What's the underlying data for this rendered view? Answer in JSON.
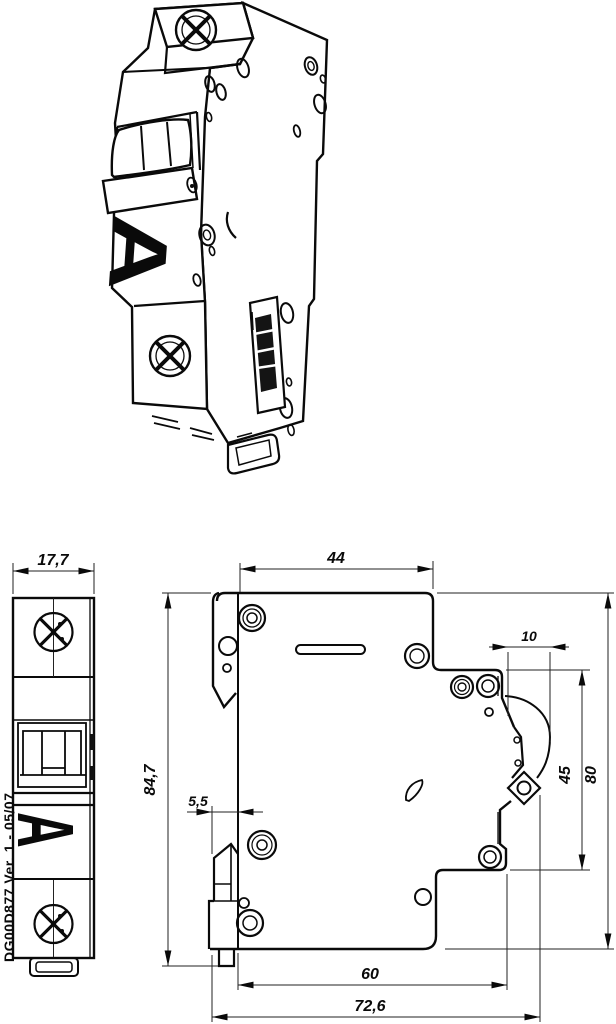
{
  "meta": {
    "drawing_number": "DG00D877 Ver. 1 - 05/07"
  },
  "markings": {
    "letter": "A"
  },
  "dimensions": {
    "front_width": "17,7",
    "top_depth": "44",
    "terminal_recess": "10",
    "terminal_height": "45",
    "body_height": "80",
    "overall_height": "84,7",
    "rail_clip": "5,5",
    "body_depth": "60",
    "overall_depth": "72,6"
  },
  "colors": {
    "ink": "#0a0a0a",
    "background": "#ffffff"
  }
}
